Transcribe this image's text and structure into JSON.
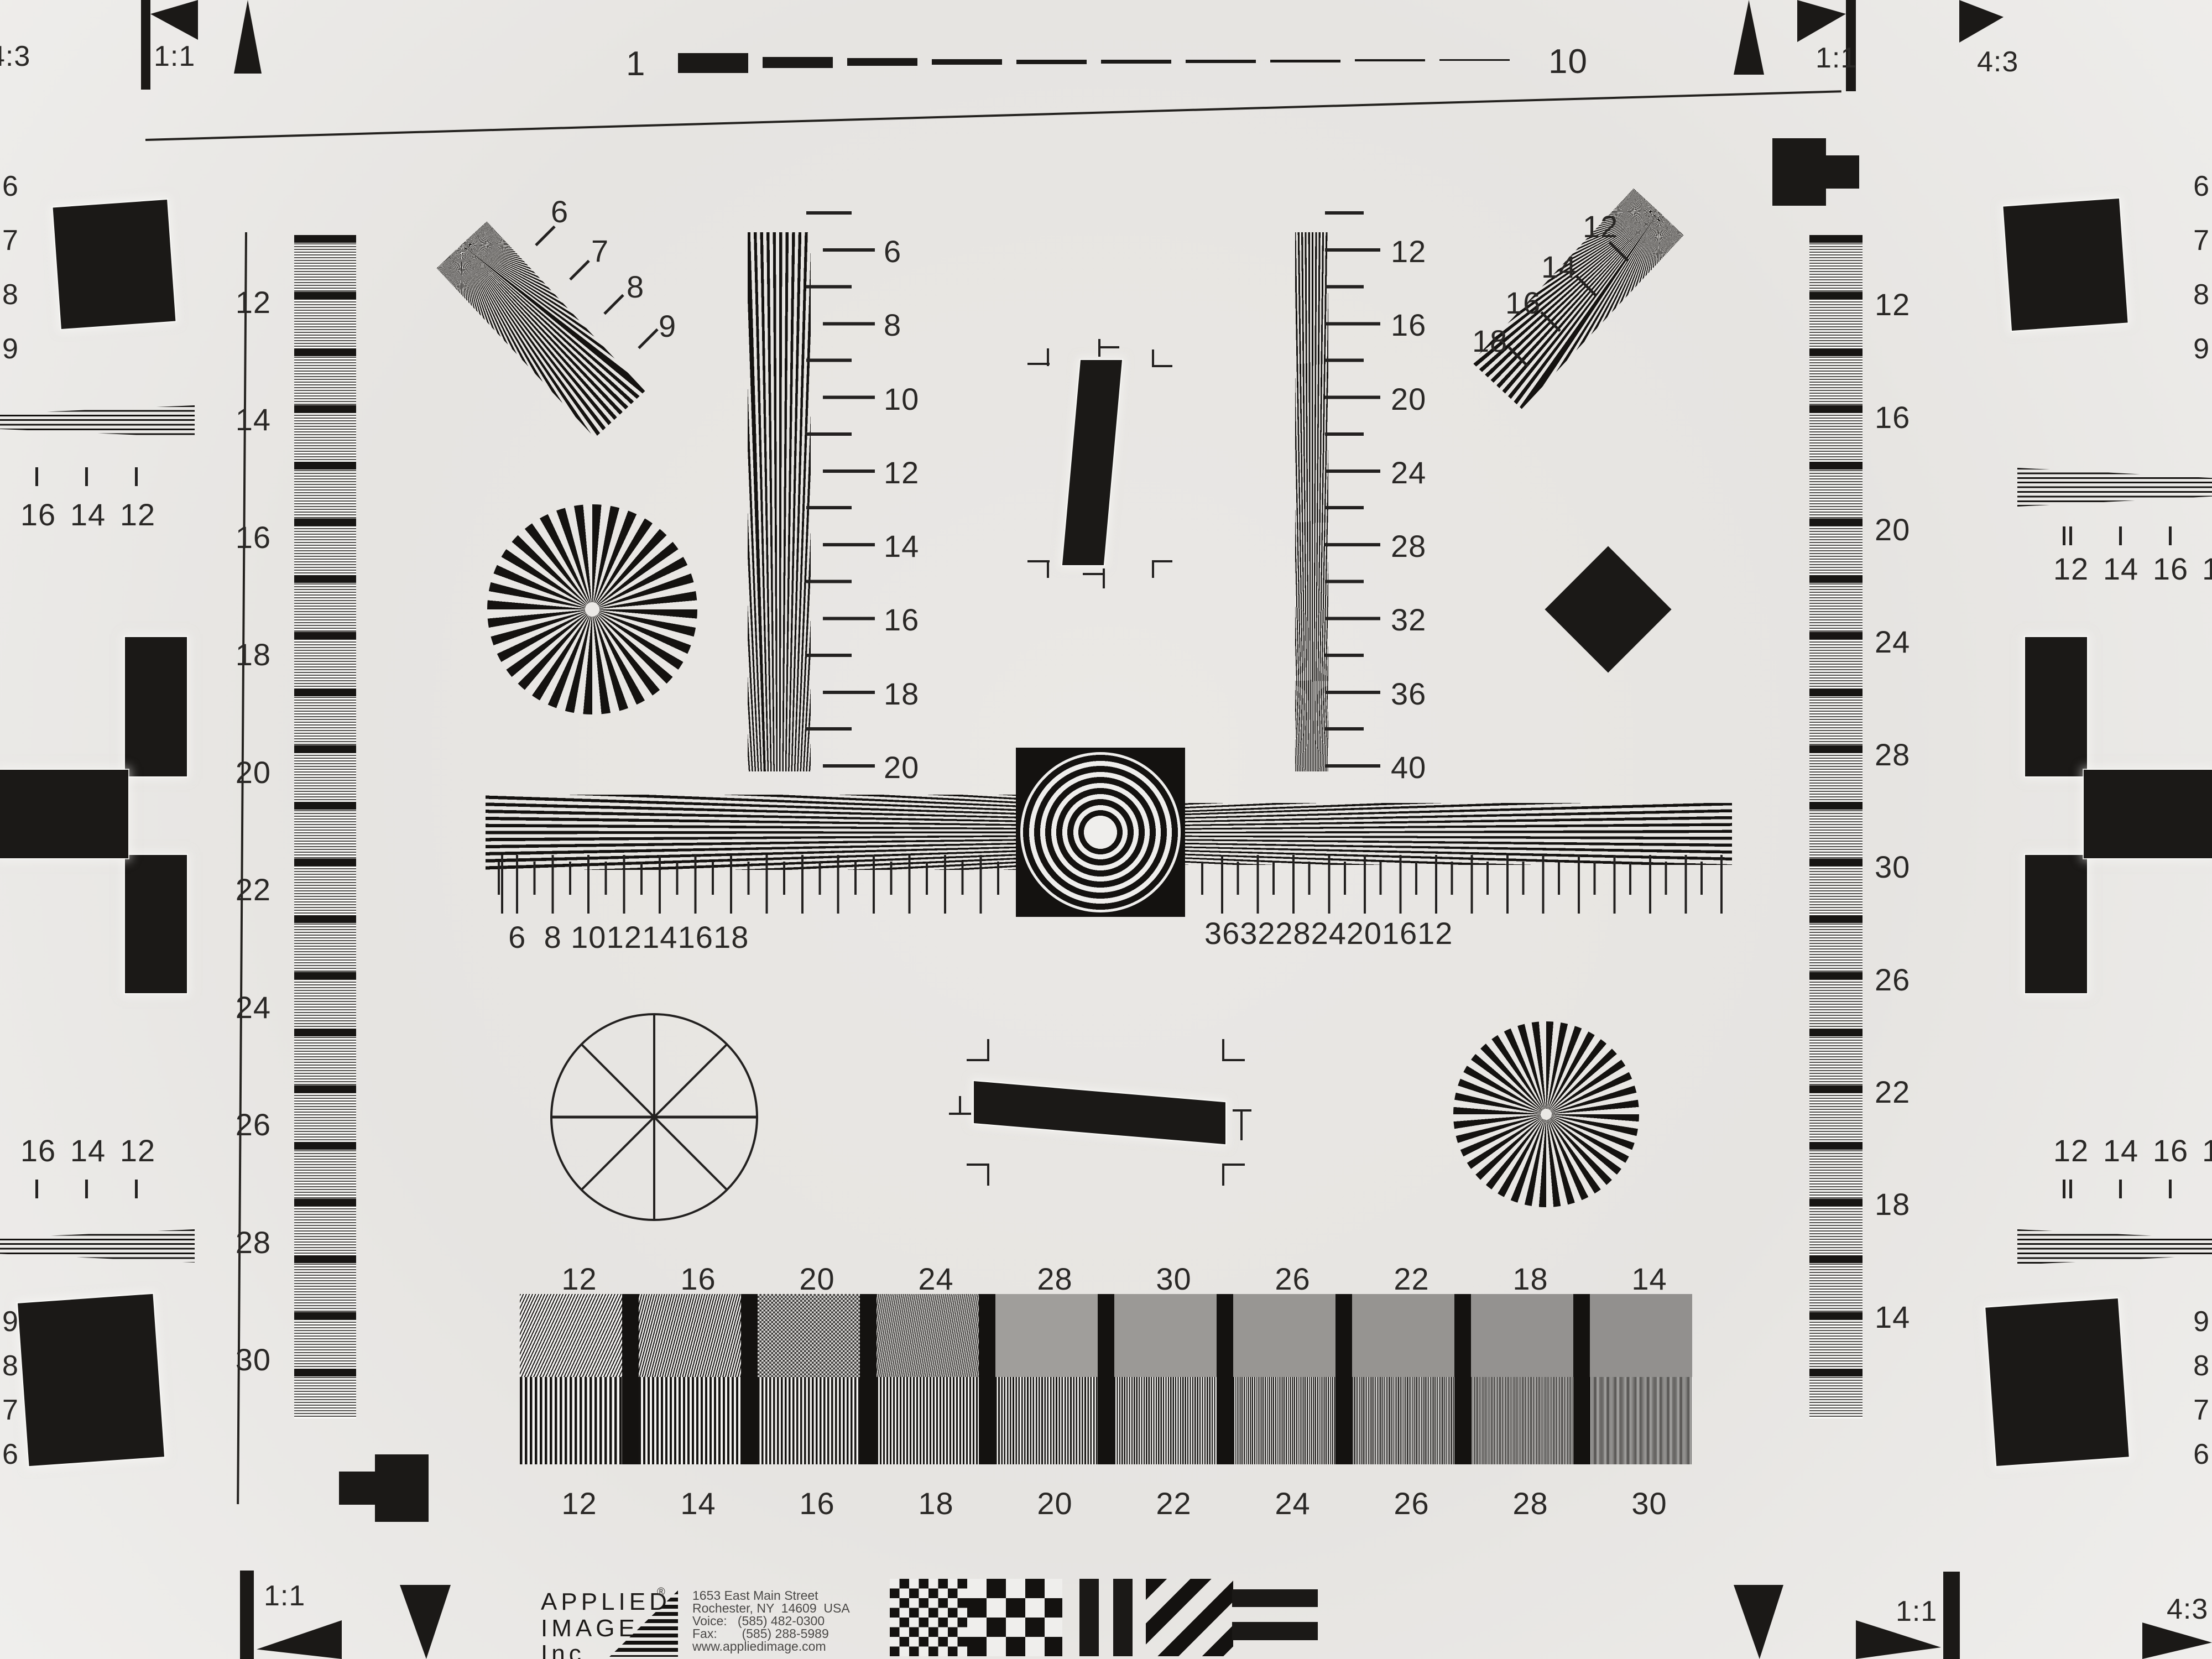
{
  "top_row": {
    "left": "1",
    "right": "10"
  },
  "corners": {
    "tl_ratio": "4:3",
    "tl_scale": "1:1",
    "tr_scale": "1:1",
    "tr_ratio": "4:3",
    "bl_scale": "1:1",
    "br_scale": "1:1",
    "br_ratio": "4:3"
  },
  "grayscale_left": [
    "12",
    "14",
    "16",
    "18",
    "20",
    "22",
    "24",
    "26",
    "28",
    "30"
  ],
  "grayscale_right": [
    "12",
    "16",
    "20",
    "24",
    "28",
    "30",
    "26",
    "22",
    "18",
    "14"
  ],
  "fan_ul": [
    "6",
    "7",
    "8",
    "9"
  ],
  "fan_ur": [
    "12",
    "14",
    "16",
    "18"
  ],
  "wedge_left": [
    "6",
    "8",
    "10",
    "12",
    "14",
    "16",
    "18",
    "20"
  ],
  "wedge_right": [
    "12",
    "16",
    "20",
    "24",
    "28",
    "32",
    "36",
    "40"
  ],
  "ruler_left": [
    "6",
    "8",
    "10",
    "12",
    "14",
    "16",
    "18"
  ],
  "ruler_right": [
    "36",
    "32",
    "28",
    "24",
    "20",
    "16",
    "12"
  ],
  "block_top": [
    "12",
    "16",
    "20",
    "24",
    "28",
    "30",
    "26",
    "22",
    "18",
    "14"
  ],
  "block_bottom": [
    "12",
    "14",
    "16",
    "18",
    "20",
    "22",
    "24",
    "26",
    "28",
    "30"
  ],
  "edges": {
    "left_top": [
      "6",
      "7",
      "8",
      "9"
    ],
    "left_mid": [
      "16",
      "14",
      "12"
    ],
    "left_mid_cut": "8",
    "left_bottom": [
      "9",
      "8",
      "7",
      "6"
    ],
    "right_top": [
      "6",
      "7",
      "8",
      "9"
    ],
    "right_mid": [
      "12",
      "14",
      "16"
    ],
    "right_mid_cut": "1",
    "right_bottom": [
      "9",
      "8",
      "7",
      "6"
    ]
  },
  "logo": {
    "line1": "APPLIED",
    "reg": "®",
    "line2": "IMAGE",
    "line3": "Inc",
    "address": [
      "1653 East Main Street",
      "Rochester, NY  14609  USA",
      "Voice:   (585) 482-0300",
      "Fax:       (585) 288-5989",
      "www.appliedimage.com"
    ]
  }
}
